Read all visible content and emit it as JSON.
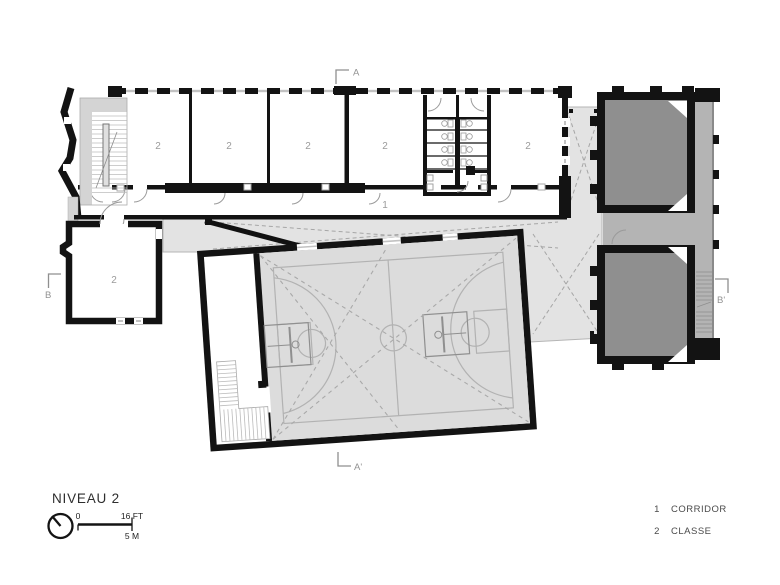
{
  "plan": {
    "title": "NIVEAU 2",
    "scale": {
      "zero": "0",
      "imperial": "16 FT",
      "metric": "5 M"
    },
    "markers": {
      "a": "A",
      "a_prime": "A'",
      "b": "B",
      "b_prime": "B'"
    },
    "rooms": {
      "corridor": "1",
      "classe": "2"
    },
    "legend": {
      "corridor_num": "1",
      "corridor_label": "CORRIDOR",
      "classe_num": "2",
      "classe_label": "CLASSE"
    }
  }
}
